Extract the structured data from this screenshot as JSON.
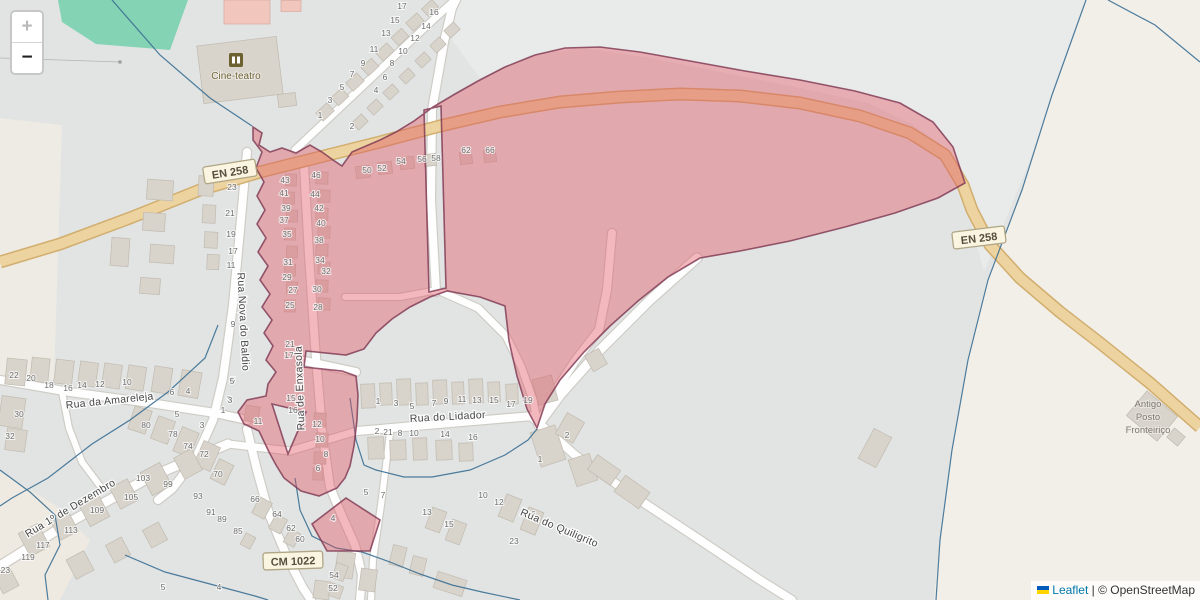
{
  "controls": {
    "zoom_in": "+",
    "zoom_out": "−"
  },
  "attribution": {
    "flag": "ukraine-flag",
    "leaflet_link": "Leaflet",
    "separator": " | ",
    "osm_credit": "© OpenStreetMap"
  },
  "road_shields": [
    {
      "label": "EN 258",
      "x": 230,
      "y": 172,
      "rot": -9
    },
    {
      "label": "EN 258",
      "x": 979,
      "y": 238,
      "rot": -7
    },
    {
      "label": "CM 1022",
      "x": 293,
      "y": 561,
      "rot": -2
    }
  ],
  "street_labels": [
    {
      "label": "Rua Nova do Baldio",
      "x": 240,
      "y": 322,
      "rot": 87
    },
    {
      "label": "Rua de Enxasola",
      "x": 303,
      "y": 388,
      "rot": -92
    },
    {
      "label": "Rua da Amareleja",
      "x": 110,
      "y": 404,
      "rot": -6
    },
    {
      "label": "Rua 1º de Dezembro",
      "x": 72,
      "y": 511,
      "rot": -31
    },
    {
      "label": "Rua do Lidador",
      "x": 448,
      "y": 420,
      "rot": -3
    },
    {
      "label": "Rua do Quiligrito",
      "x": 558,
      "y": 531,
      "rot": 23
    }
  ],
  "poi_labels": {
    "cinema": {
      "label": "Cine-teatro",
      "x": 236,
      "y": 79,
      "icon": "cinema-icon",
      "icon_x": 236,
      "icon_y": 60
    },
    "border_post": {
      "lines": [
        "Antigo",
        "Posto",
        "Fronteiriço"
      ],
      "x": 1148,
      "y": 407,
      "line_height": 13
    }
  },
  "house_numbers": [
    [
      "23",
      232,
      190
    ],
    [
      "21",
      230,
      216
    ],
    [
      "19",
      231,
      237
    ],
    [
      "17",
      233,
      254
    ],
    [
      "11",
      231,
      268
    ],
    [
      "9",
      233,
      327
    ],
    [
      "7",
      244,
      347
    ],
    [
      "5",
      233,
      383
    ],
    [
      "3",
      229,
      402
    ],
    [
      "1",
      223,
      413
    ],
    [
      "43",
      285,
      183
    ],
    [
      "41",
      284,
      196
    ],
    [
      "39",
      286,
      211
    ],
    [
      "37",
      284,
      223
    ],
    [
      "35",
      287,
      237
    ],
    [
      "31",
      288,
      265
    ],
    [
      "29",
      287,
      280
    ],
    [
      "27",
      293,
      293
    ],
    [
      "25",
      290,
      308
    ],
    [
      "21",
      290,
      347
    ],
    [
      "17",
      289,
      358
    ],
    [
      "15",
      291,
      401
    ],
    [
      "16",
      293,
      413
    ],
    [
      "11",
      258,
      424
    ],
    [
      "46",
      316,
      178
    ],
    [
      "44",
      315,
      197
    ],
    [
      "42",
      319,
      211
    ],
    [
      "40",
      321,
      226
    ],
    [
      "38",
      319,
      243
    ],
    [
      "34",
      320,
      263
    ],
    [
      "32",
      326,
      274
    ],
    [
      "30",
      317,
      292
    ],
    [
      "28",
      318,
      310
    ],
    [
      "12",
      317,
      427
    ],
    [
      "10",
      320,
      442
    ],
    [
      "8",
      326,
      457
    ],
    [
      "6",
      318,
      471
    ],
    [
      "50",
      367,
      173
    ],
    [
      "52",
      382,
      171
    ],
    [
      "54",
      401,
      164
    ],
    [
      "56",
      422,
      162
    ],
    [
      "58",
      436,
      161
    ],
    [
      "62",
      466,
      153
    ],
    [
      "66",
      490,
      153
    ],
    [
      "1",
      320,
      118
    ],
    [
      "3",
      330,
      103
    ],
    [
      "5",
      342,
      90
    ],
    [
      "7",
      352,
      77
    ],
    [
      "9",
      363,
      66
    ],
    [
      "11",
      374,
      52
    ],
    [
      "13",
      386,
      36
    ],
    [
      "15",
      395,
      23
    ],
    [
      "17",
      402,
      9
    ],
    [
      "2",
      352,
      129
    ],
    [
      "4",
      376,
      93
    ],
    [
      "6",
      385,
      80
    ],
    [
      "8",
      392,
      66
    ],
    [
      "10",
      403,
      54
    ],
    [
      "12",
      415,
      41
    ],
    [
      "14",
      426,
      29
    ],
    [
      "16",
      434,
      15
    ],
    [
      "22",
      14,
      378
    ],
    [
      "20",
      31,
      381
    ],
    [
      "18",
      49,
      388
    ],
    [
      "16",
      68,
      391
    ],
    [
      "14",
      82,
      388
    ],
    [
      "12",
      100,
      387
    ],
    [
      "10",
      127,
      385
    ],
    [
      "6",
      172,
      395
    ],
    [
      "4",
      188,
      394
    ],
    [
      "5",
      232,
      384
    ],
    [
      "3",
      230,
      403
    ],
    [
      "30",
      19,
      417
    ],
    [
      "32",
      10,
      439
    ],
    [
      "5",
      177,
      417
    ],
    [
      "3",
      202,
      428
    ],
    [
      "80",
      146,
      428
    ],
    [
      "78",
      173,
      437
    ],
    [
      "74",
      188,
      449
    ],
    [
      "72",
      204,
      457
    ],
    [
      "70",
      218,
      477
    ],
    [
      "103",
      143,
      481
    ],
    [
      "99",
      168,
      487
    ],
    [
      "93",
      198,
      499
    ],
    [
      "105",
      131,
      500
    ],
    [
      "109",
      97,
      513
    ],
    [
      "113",
      71,
      533
    ],
    [
      "117",
      43,
      548
    ],
    [
      "119",
      28,
      560
    ],
    [
      "123",
      3,
      573
    ],
    [
      "91",
      211,
      515
    ],
    [
      "89",
      222,
      522
    ],
    [
      "85",
      238,
      534
    ],
    [
      "66",
      255,
      502
    ],
    [
      "64",
      277,
      517
    ],
    [
      "62",
      291,
      531
    ],
    [
      "60",
      300,
      542
    ],
    [
      "54",
      334,
      578
    ],
    [
      "52",
      333,
      591
    ],
    [
      "1",
      378,
      404
    ],
    [
      "3",
      396,
      406
    ],
    [
      "5",
      412,
      409
    ],
    [
      "7",
      434,
      406
    ],
    [
      "9",
      446,
      404
    ],
    [
      "11",
      462,
      402
    ],
    [
      "13",
      477,
      403
    ],
    [
      "15",
      494,
      403
    ],
    [
      "17",
      511,
      407
    ],
    [
      "19",
      528,
      403
    ],
    [
      "2",
      377,
      434
    ],
    [
      "21",
      388,
      435
    ],
    [
      "8",
      400,
      436
    ],
    [
      "10",
      414,
      436
    ],
    [
      "14",
      445,
      437
    ],
    [
      "16",
      473,
      440
    ],
    [
      "2",
      567,
      438
    ],
    [
      "1",
      540,
      462
    ],
    [
      "10",
      483,
      498
    ],
    [
      "12",
      499,
      505
    ],
    [
      "16",
      531,
      517
    ],
    [
      "13",
      427,
      515
    ],
    [
      "15",
      449,
      527
    ],
    [
      "23",
      514,
      544
    ],
    [
      "5",
      366,
      495
    ],
    [
      "7",
      383,
      498
    ],
    [
      "4",
      333,
      521
    ],
    [
      "5",
      163,
      590
    ],
    [
      "4",
      219,
      590
    ]
  ],
  "colors": {
    "base": "#e1e4e3",
    "base_light": "#e9ebea",
    "cream": "#f2efe9",
    "green_area": "#84d3b5",
    "road_primary": "#ecd3a0",
    "road_primary_casing": "#d2ae6e",
    "street_fill": "#fefefe",
    "street_casing": "#cfccc6",
    "building": "#d8d3cb",
    "building_pink": "#f0c6bd",
    "boundary_line": "#3b6f94",
    "overlay_fill": "#e2505e",
    "overlay_stroke": "#7d3450",
    "shield_bg": "#faf5e0",
    "shield_border": "#b0a686"
  }
}
